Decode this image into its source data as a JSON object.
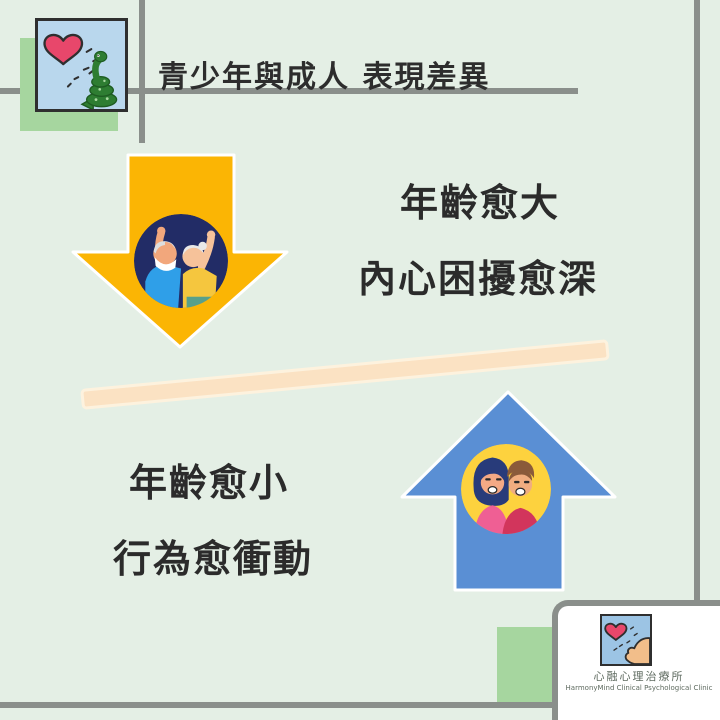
{
  "theme": {
    "background_color": "#e4efe5",
    "line_color": "#8a8f8b",
    "accent_green": "#a6d69f",
    "text_color": "#2b2b2b",
    "divider_color": "#fbe2c3"
  },
  "header": {
    "title": "青少年與成人 表現差異"
  },
  "adult_section": {
    "arrow_direction": "down",
    "arrow_color": "#fbb504",
    "circle_bg": "#222c66",
    "illustration": "elderly-couple-raising-arms",
    "line1": "年齡愈大",
    "line2": "內心困擾愈深"
  },
  "youth_section": {
    "arrow_direction": "up",
    "arrow_color": "#5a8fd4",
    "circle_bg": "#fdd23e",
    "illustration": "young-couple-smiling",
    "line1": "年齡愈小",
    "line2": "行為愈衝動"
  },
  "corner_picture": {
    "description": "snake-looking-at-heart",
    "heart_color": "#e8476b",
    "snake_color": "#2e7d32",
    "frame_bg": "#b9d7ed"
  },
  "footer_logo": {
    "description": "face-blowing-at-heart",
    "clinic_name_zh": "心融心理治療所",
    "clinic_name_en": "HarmonyMind Clinical Psychological Clinic"
  }
}
